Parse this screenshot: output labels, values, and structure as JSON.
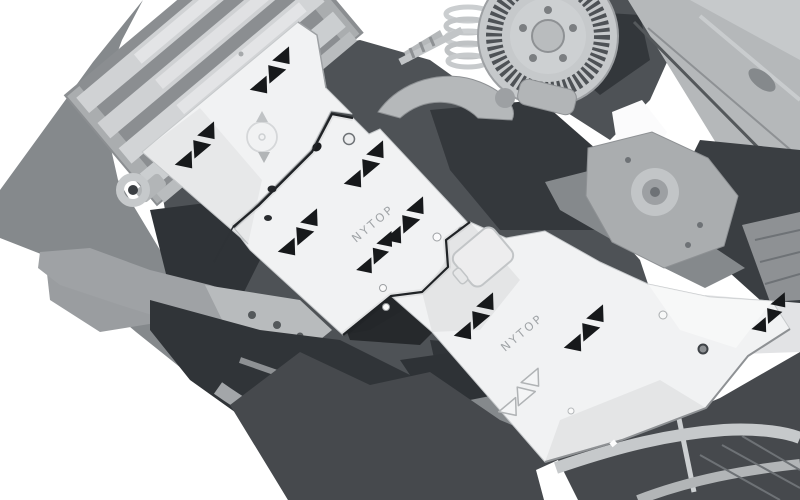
{
  "image": {
    "alt": "Grayscale 3D render of a pickup truck underbody with a three-piece NYTOP skid plate set installed",
    "width": 800,
    "height": 500,
    "background": "#ffffff"
  },
  "branding": {
    "name": "NYTOP"
  },
  "plates": {
    "front": {
      "label": "",
      "cutout_clusters": 2,
      "emblem": "compass-emblem"
    },
    "mid": {
      "label": "NYTOP",
      "cutout_clusters": 4
    },
    "rear": {
      "label": "NYTOP",
      "cutout_clusters": 3,
      "feature": "access-door"
    }
  },
  "colors": {
    "plate": "#f1f2f3",
    "plate_edge": "#c6c9cb",
    "cutout": "#17191b",
    "engraving": "#9ca0a3",
    "chassis_light": "#c3c6c8",
    "chassis_mid": "#85898c",
    "chassis_dark": "#4e5256",
    "shadow_dark": "#2e3236"
  }
}
